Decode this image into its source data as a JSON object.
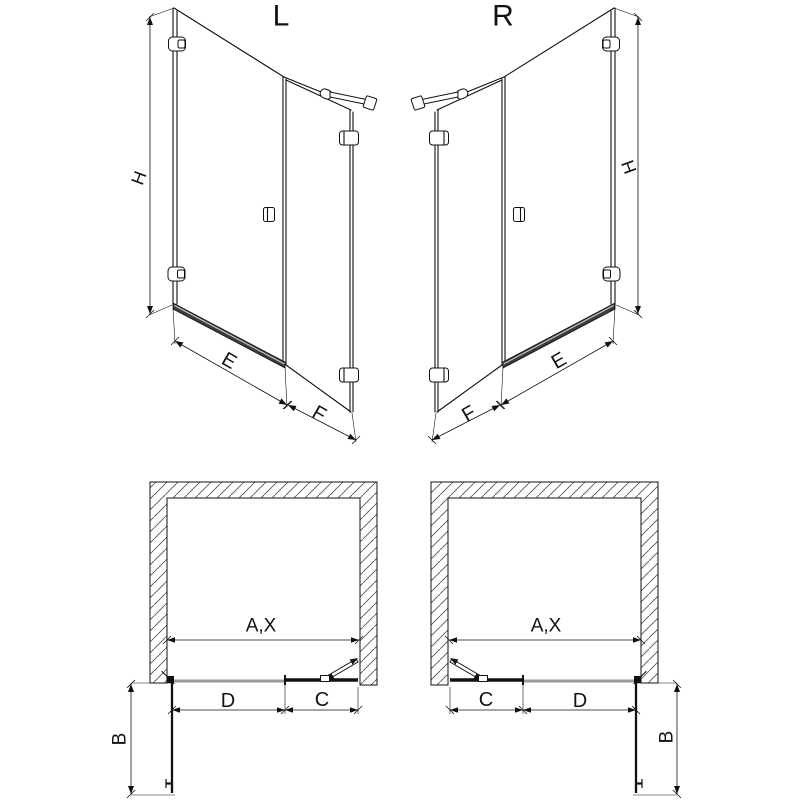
{
  "colors": {
    "background": "#ffffff",
    "line": "#111111",
    "threshold_fill": "#3d3d3d",
    "sill_gray": "#9a9a9a",
    "hatch": "#555555"
  },
  "elevations": {
    "left": {
      "title": "L",
      "height": "H",
      "door_width": "E",
      "side_panel_width": "F"
    },
    "right": {
      "title": "R",
      "height": "H",
      "door_width": "E",
      "side_panel_width": "F"
    }
  },
  "plans": {
    "left": {
      "opening_width": "A,X",
      "door_width": "D",
      "side_panel_width": "C",
      "door_swing": "B"
    },
    "right": {
      "opening_width": "A,X",
      "door_width": "D",
      "side_panel_width": "C",
      "door_swing": "B"
    }
  }
}
